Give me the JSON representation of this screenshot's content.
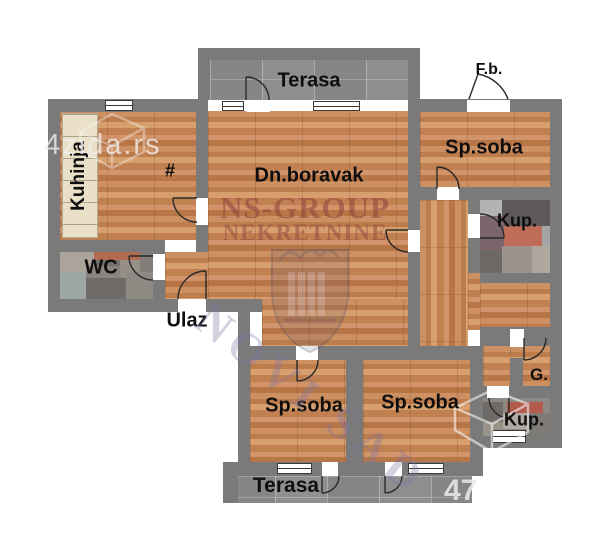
{
  "floorplan": {
    "rooms": {
      "terasa_top": {
        "label": "Terasa"
      },
      "fb": {
        "label": "F.b."
      },
      "kuhinja": {
        "label": "Kuhinja"
      },
      "dining_mark": {
        "label": "#"
      },
      "dn_boravak": {
        "label": "Dn.boravak"
      },
      "sp_soba_top": {
        "label": "Sp.soba"
      },
      "kup_top": {
        "label": "Kup."
      },
      "wc": {
        "label": "WC"
      },
      "ulaz": {
        "label": "Ulaz"
      },
      "sp_soba_left": {
        "label": "Sp.soba"
      },
      "sp_soba_mid": {
        "label": "Sp.soba"
      },
      "garderoba": {
        "label": "G."
      },
      "kup_bottom": {
        "label": "Kup."
      },
      "terasa_bottom": {
        "label": "Terasa"
      }
    },
    "watermarks": {
      "site": {
        "text": "4zida.rs"
      },
      "agency_line1": {
        "text": "NS-GROUP"
      },
      "agency_line2": {
        "text": "NEKRETNINE"
      },
      "city": {
        "text": "NOVI SAD"
      },
      "corner": {
        "text": "47"
      }
    },
    "colors": {
      "wall": "#7a7a7a",
      "wood": "#c6875a",
      "terrace_tile": "#898989",
      "accent_red": "#b25a4c"
    }
  }
}
